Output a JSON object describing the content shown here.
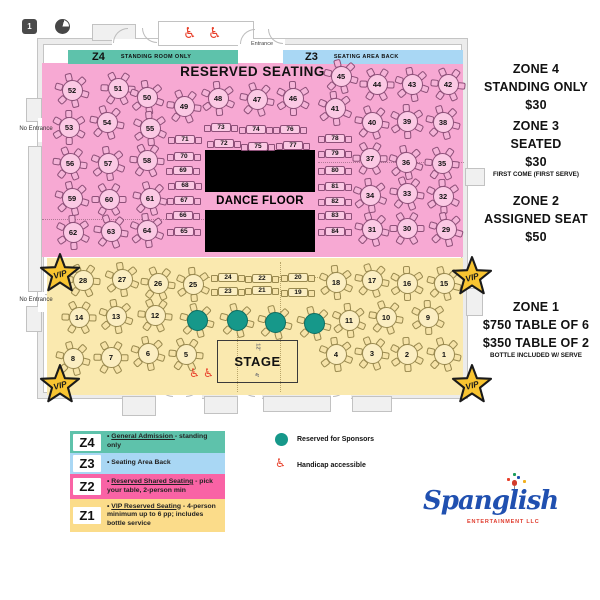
{
  "toolbar": {
    "page_badge": "1"
  },
  "colors": {
    "zone2_pink": "#f7a9d3",
    "zone1_yellow": "#fae9af",
    "z4_teal": "#5ec2ab",
    "z3_blue": "#a9d7f4",
    "legend_z2_pink": "#f963a5",
    "legend_z1_yellow": "#fbdc8a",
    "sponsor_teal": "#16988a",
    "handicap_red": "#e8402b",
    "vip_gold": "#f8c431",
    "dance_floor": "#000000"
  },
  "plan": {
    "entrance": "Entrance",
    "no_entrance": "No Entrance",
    "reserved_seating": "RESERVED SEATING",
    "dance_floor": "DANCE FLOOR",
    "stage_label": "STAGE",
    "stage_width": "12'",
    "stage_depth": "4'",
    "vip": "VIP",
    "band_z4": {
      "code": "Z4",
      "label": "STANDING ROOM ONLY"
    },
    "band_z3": {
      "code": "Z3",
      "label": "SEATING AREA BACK"
    },
    "tables": {
      "zone2_round": [
        {
          "n": "52",
          "x": 72,
          "y": 90
        },
        {
          "n": "51",
          "x": 118,
          "y": 88
        },
        {
          "n": "50",
          "x": 147,
          "y": 97
        },
        {
          "n": "49",
          "x": 184,
          "y": 106
        },
        {
          "n": "48",
          "x": 218,
          "y": 98
        },
        {
          "n": "47",
          "x": 257,
          "y": 99
        },
        {
          "n": "46",
          "x": 293,
          "y": 98
        },
        {
          "n": "45",
          "x": 341,
          "y": 76
        },
        {
          "n": "44",
          "x": 377,
          "y": 84
        },
        {
          "n": "43",
          "x": 412,
          "y": 84
        },
        {
          "n": "42",
          "x": 448,
          "y": 84
        },
        {
          "n": "53",
          "x": 69,
          "y": 127
        },
        {
          "n": "54",
          "x": 107,
          "y": 122
        },
        {
          "n": "55",
          "x": 150,
          "y": 128
        },
        {
          "n": "41",
          "x": 335,
          "y": 108
        },
        {
          "n": "40",
          "x": 372,
          "y": 122
        },
        {
          "n": "39",
          "x": 407,
          "y": 121
        },
        {
          "n": "38",
          "x": 443,
          "y": 122
        },
        {
          "n": "56",
          "x": 70,
          "y": 163
        },
        {
          "n": "57",
          "x": 108,
          "y": 163
        },
        {
          "n": "58",
          "x": 147,
          "y": 160
        },
        {
          "n": "37",
          "x": 370,
          "y": 158
        },
        {
          "n": "36",
          "x": 406,
          "y": 162
        },
        {
          "n": "35",
          "x": 442,
          "y": 163
        },
        {
          "n": "59",
          "x": 72,
          "y": 198
        },
        {
          "n": "60",
          "x": 109,
          "y": 199
        },
        {
          "n": "61",
          "x": 150,
          "y": 198
        },
        {
          "n": "34",
          "x": 370,
          "y": 195
        },
        {
          "n": "33",
          "x": 407,
          "y": 193
        },
        {
          "n": "32",
          "x": 443,
          "y": 196
        },
        {
          "n": "62",
          "x": 73,
          "y": 232
        },
        {
          "n": "63",
          "x": 111,
          "y": 231
        },
        {
          "n": "64",
          "x": 147,
          "y": 230
        },
        {
          "n": "31",
          "x": 372,
          "y": 229
        },
        {
          "n": "30",
          "x": 407,
          "y": 228
        },
        {
          "n": "29",
          "x": 446,
          "y": 229
        }
      ],
      "zone2_small": [
        {
          "n": "71",
          "x": 185,
          "y": 139
        },
        {
          "n": "70",
          "x": 184,
          "y": 156
        },
        {
          "n": "69",
          "x": 183,
          "y": 170
        },
        {
          "n": "68",
          "x": 185,
          "y": 185
        },
        {
          "n": "67",
          "x": 184,
          "y": 200
        },
        {
          "n": "66",
          "x": 183,
          "y": 215
        },
        {
          "n": "65",
          "x": 184,
          "y": 231
        },
        {
          "n": "73",
          "x": 221,
          "y": 127
        },
        {
          "n": "74",
          "x": 256,
          "y": 129
        },
        {
          "n": "76",
          "x": 290,
          "y": 129
        },
        {
          "n": "72",
          "x": 224,
          "y": 143
        },
        {
          "n": "75",
          "x": 258,
          "y": 146
        },
        {
          "n": "77",
          "x": 293,
          "y": 145
        },
        {
          "n": "78",
          "x": 335,
          "y": 138
        },
        {
          "n": "79",
          "x": 335,
          "y": 153
        },
        {
          "n": "80",
          "x": 335,
          "y": 170
        },
        {
          "n": "81",
          "x": 335,
          "y": 186
        },
        {
          "n": "82",
          "x": 335,
          "y": 201
        },
        {
          "n": "83",
          "x": 335,
          "y": 215
        },
        {
          "n": "84",
          "x": 335,
          "y": 231
        }
      ],
      "zone1_round": [
        {
          "n": "28",
          "x": 83,
          "y": 280
        },
        {
          "n": "27",
          "x": 122,
          "y": 279
        },
        {
          "n": "26",
          "x": 158,
          "y": 283
        },
        {
          "n": "25",
          "x": 193,
          "y": 284
        },
        {
          "n": "18",
          "x": 336,
          "y": 282
        },
        {
          "n": "17",
          "x": 372,
          "y": 280
        },
        {
          "n": "16",
          "x": 407,
          "y": 283
        },
        {
          "n": "15",
          "x": 444,
          "y": 283
        },
        {
          "n": "14",
          "x": 79,
          "y": 317
        },
        {
          "n": "13",
          "x": 116,
          "y": 316
        },
        {
          "n": "12",
          "x": 155,
          "y": 315
        },
        {
          "n": "11",
          "x": 349,
          "y": 320
        },
        {
          "n": "10",
          "x": 386,
          "y": 317
        },
        {
          "n": "9",
          "x": 428,
          "y": 317
        },
        {
          "n": "8",
          "x": 73,
          "y": 358
        },
        {
          "n": "7",
          "x": 111,
          "y": 357
        },
        {
          "n": "6",
          "x": 148,
          "y": 353
        },
        {
          "n": "5",
          "x": 186,
          "y": 354
        },
        {
          "n": "4",
          "x": 336,
          "y": 354
        },
        {
          "n": "3",
          "x": 372,
          "y": 353
        },
        {
          "n": "2",
          "x": 407,
          "y": 354
        },
        {
          "n": "1",
          "x": 444,
          "y": 354
        }
      ],
      "zone1_small": [
        {
          "n": "24",
          "x": 228,
          "y": 277
        },
        {
          "n": "23",
          "x": 228,
          "y": 291
        },
        {
          "n": "22",
          "x": 262,
          "y": 278
        },
        {
          "n": "21",
          "x": 262,
          "y": 290
        },
        {
          "n": "20",
          "x": 298,
          "y": 277
        },
        {
          "n": "19",
          "x": 298,
          "y": 292
        }
      ],
      "sponsor": [
        {
          "x": 197,
          "y": 320
        },
        {
          "x": 237,
          "y": 320
        },
        {
          "x": 275,
          "y": 322
        },
        {
          "x": 314,
          "y": 323
        }
      ]
    },
    "vip_stars": [
      {
        "x": 60,
        "y": 273
      },
      {
        "x": 60,
        "y": 384
      },
      {
        "x": 472,
        "y": 276
      },
      {
        "x": 472,
        "y": 384
      }
    ],
    "handicap_icons": [
      {
        "x": 183,
        "y": 26,
        "s": 15
      },
      {
        "x": 208,
        "y": 26,
        "s": 15
      },
      {
        "x": 189,
        "y": 367,
        "s": 12
      },
      {
        "x": 203,
        "y": 367,
        "s": 12
      }
    ]
  },
  "pricing": [
    {
      "title": "ZONE 4",
      "lines": [
        "STANDING ONLY",
        "$30"
      ],
      "note": ""
    },
    {
      "title": "ZONE 3",
      "lines": [
        "SEATED",
        "$30"
      ],
      "note": "FIRST COME (FIRST SERVE)"
    },
    {
      "title": "ZONE 2",
      "lines": [
        "ASSIGNED SEAT",
        "$50"
      ],
      "note": ""
    },
    {
      "title": "ZONE 1",
      "lines": [
        "$750 TABLE OF 6",
        "$350 TABLE OF 2"
      ],
      "note": "BOTTLE INCLUDED W/ SERVE"
    }
  ],
  "legend": {
    "zones": [
      {
        "code": "Z4",
        "color": "#5ec2ab",
        "parts": [
          {
            "t": "General Admission ",
            "u": true
          },
          {
            "t": "- standing only",
            "u": false
          }
        ]
      },
      {
        "code": "Z3",
        "color": "#a9d7f4",
        "parts": [
          {
            "t": "Seating Area Back",
            "u": false
          }
        ]
      },
      {
        "code": "Z2",
        "color": "#f963a5",
        "parts": [
          {
            "t": "Reserved Shared Seating",
            "u": true
          },
          {
            "t": " - pick your table,  2-person min",
            "u": false
          }
        ]
      },
      {
        "code": "Z1",
        "color": "#fbdc8a",
        "parts": [
          {
            "t": "VIP Reserved Seating",
            "u": true
          },
          {
            "t": " - 4-person minimum up to 6 pp; includes bottle service",
            "u": false
          }
        ]
      }
    ],
    "sponsor_label": "Reserved for Sponsors",
    "handicap_label": "Handicap accessible"
  },
  "logo": {
    "name": "Spanglish",
    "sub": "ENTERTAINMENT LLC"
  }
}
